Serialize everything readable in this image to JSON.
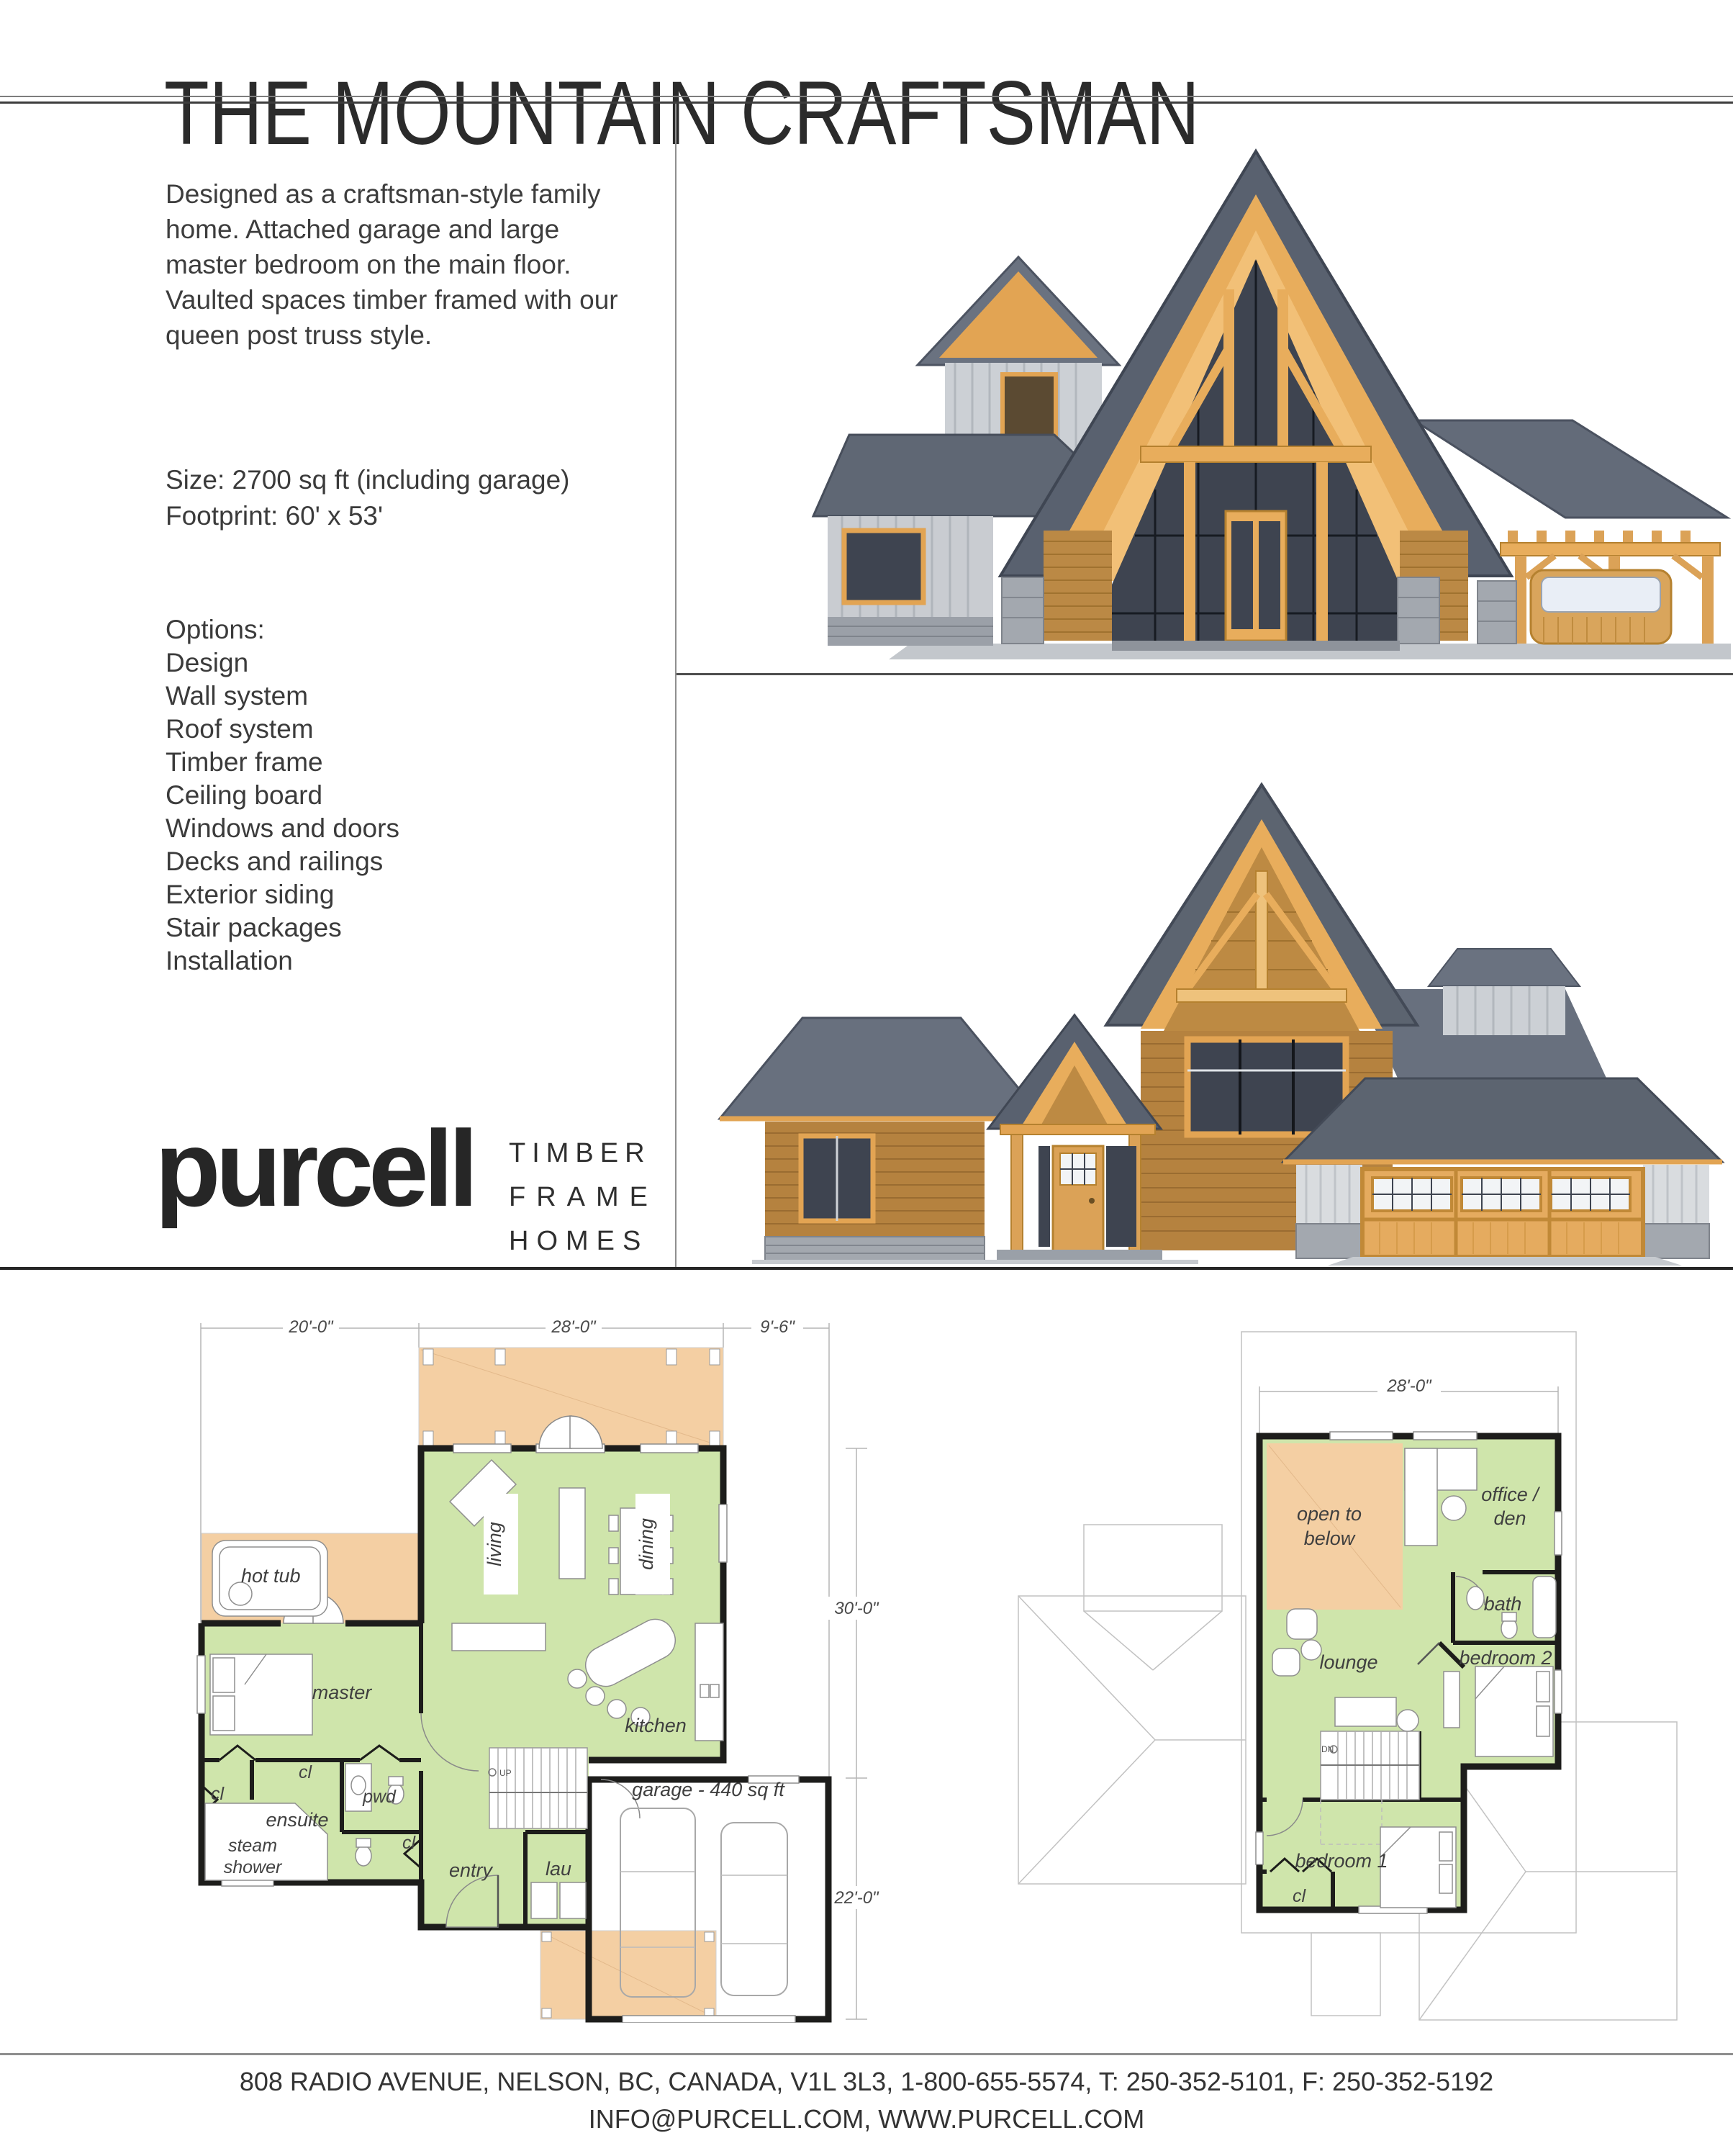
{
  "page": {
    "title": "THE MOUNTAIN CRAFTSMAN"
  },
  "intro": {
    "description": "Designed as a craftsman-style family home. Attached garage and large master bedroom on the main floor. Vaulted spaces timber framed with our queen post truss style.",
    "size_line1": "Size: 2700 sq ft (including garage)",
    "size_line2": "Footprint: 60' x 53'"
  },
  "options": {
    "heading": "Options:",
    "items": [
      "Design",
      "Wall system",
      "Roof system",
      "Timber frame",
      "Ceiling board",
      "Windows and doors",
      "Decks and railings",
      "Exterior siding",
      "Stair packages",
      "Installation"
    ]
  },
  "logo": {
    "wordmark": "purcell",
    "tagline": [
      "TIMBER",
      "FRAME",
      "HOMES"
    ]
  },
  "plans": {
    "main": {
      "dims": {
        "w1": "20'-0\"",
        "w2": "28'-0\"",
        "w3": "9'-6\"",
        "d1": "30'-0\"",
        "d2": "22'-0\""
      },
      "labels": {
        "hot_tub": "hot tub",
        "living": "living",
        "dining": "dining",
        "master": "master",
        "kitchen": "kitchen",
        "cl1": "cl",
        "cl2": "cl",
        "cl3": "cl",
        "ensuite": "ensuite",
        "steam1": "steam",
        "steam2": "shower",
        "pwd": "pwd",
        "entry": "entry",
        "lau": "lau",
        "garage": "garage - 440 sq ft",
        "up": "UP"
      }
    },
    "upper": {
      "dims": {
        "w1": "28'-0\""
      },
      "labels": {
        "open1": "open to",
        "open2": "below",
        "office1": "office /",
        "office2": "den",
        "bath": "bath",
        "bedroom2": "bedroom 2",
        "lounge": "lounge",
        "bedroom1": "bedroom 1",
        "cl": "cl",
        "dn": "DN"
      }
    }
  },
  "footer": {
    "line1": "808 RADIO AVENUE, NELSON, BC, CANADA, V1L 3L3, 1-800-655-5574, T: 250-352-5101, F: 250-352-5192",
    "line2": "INFO@PURCELL.COM, WWW.PURCELL.COM"
  },
  "colors": {
    "floor_green": "#cfe5ab",
    "deck_tan": "#f4cfa3",
    "wall_black": "#1d1d1b",
    "timber": "#e2a453",
    "roof": "#59616f",
    "stone": "#a3a8af",
    "glass": "#3e4450",
    "shingle": "#b5823f",
    "siding": "#ced1d6"
  }
}
